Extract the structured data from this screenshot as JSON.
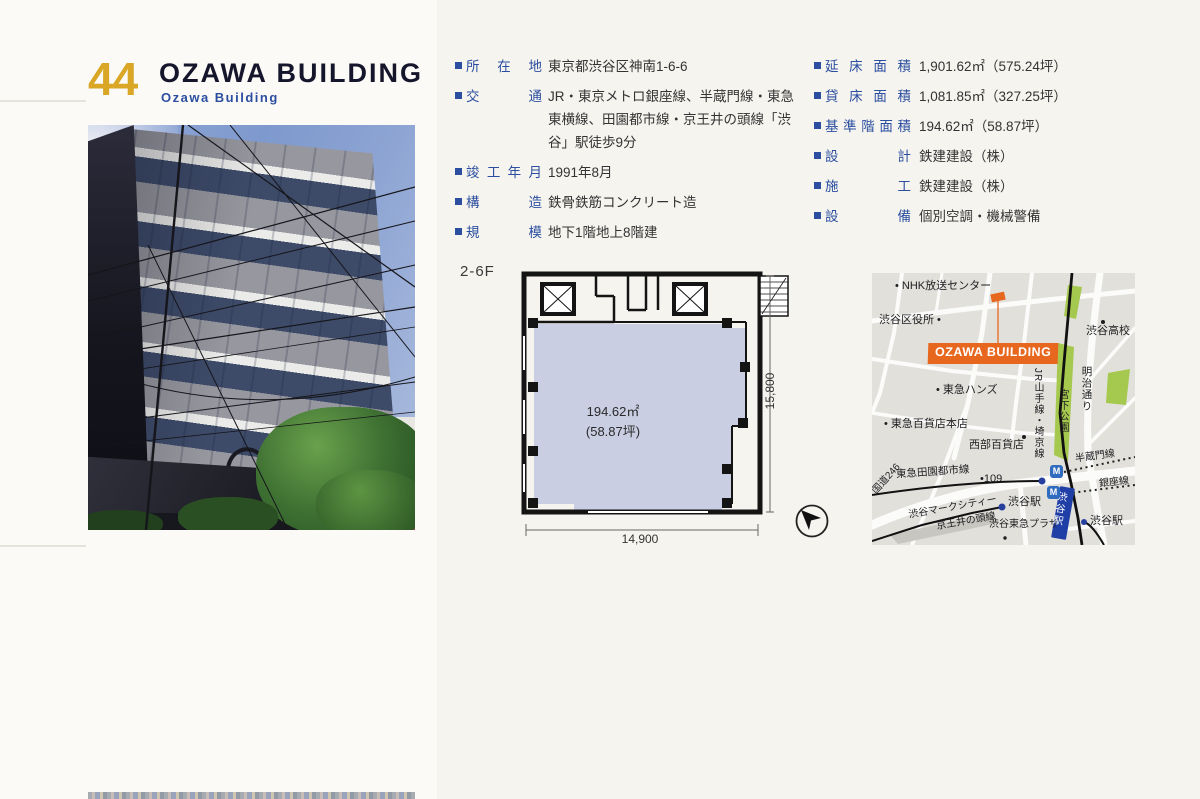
{
  "page": {
    "number": "44",
    "title": "OZAWA BUILDING",
    "subtitle": "Ozawa Building"
  },
  "colors": {
    "accent_gold": "#d9a625",
    "accent_blue": "#2b4ea0",
    "accent_orange": "#e8671f",
    "plan_fill": "#c9cee2",
    "map_green": "#a5c84e",
    "station_blue": "#1f3ea6"
  },
  "details_left": [
    {
      "label": "所在地",
      "value": "東京都渋谷区神南1-6-6"
    },
    {
      "label": "交通",
      "value": "JR・東京メトロ銀座線、半蔵門線・東急東横線、田園都市線・京王井の頭線「渋谷」駅徒歩9分"
    },
    {
      "label": "竣工年月",
      "value": "1991年8月"
    },
    {
      "label": "構造",
      "value": "鉄骨鉄筋コンクリート造"
    },
    {
      "label": "規模",
      "value": "地下1階地上8階建"
    }
  ],
  "details_right": [
    {
      "label": "延床面積",
      "value": "1,901.62㎡（575.24坪）"
    },
    {
      "label": "貸床面積",
      "value": "1,081.85㎡（327.25坪）"
    },
    {
      "label": "基準階面積",
      "value": "194.62㎡（58.87坪）"
    },
    {
      "label": "設計",
      "value": "鉄建建設（株）"
    },
    {
      "label": "施工",
      "value": "鉄建建設（株）"
    },
    {
      "label": "設備",
      "value": "個別空調・機械警備"
    }
  ],
  "floor_plan": {
    "floor_label": "2-6F",
    "area_line1": "194.62㎡",
    "area_line2": "(58.87坪)",
    "dim_height": "15,800",
    "dim_width": "14,900"
  },
  "map": {
    "building_label": "OZAWA BUILDING",
    "metro_glyph": "M",
    "labels": {
      "nhk": "• NHK放送センター",
      "ward_office": "渋谷区役所 •",
      "shibuya_hs": "渋谷高校",
      "tokyu_hands": "• 東急ハンズ",
      "tokyu_dept": "• 東急百貨店本店",
      "seibu_dept": "西部百貨店",
      "denentoshi": "東急田園都市線",
      "route109": "•109",
      "route246": "国道246",
      "mark_city": "渋谷マークシティー",
      "inokashira": "京王井の頭線",
      "shibuya_sta_keio": "渋谷駅",
      "tokyu_plaza": "渋谷東急プラザ",
      "jr_lines": "JR山手線・埼京線",
      "miyashita_park": "宮下公園",
      "meiji_dori": "明治通り",
      "hanzomon": "半蔵門線",
      "ginza": "銀座線",
      "shibuya_sta_jr": "渋谷駅",
      "shibuya_sta_east": "渋谷駅"
    }
  }
}
